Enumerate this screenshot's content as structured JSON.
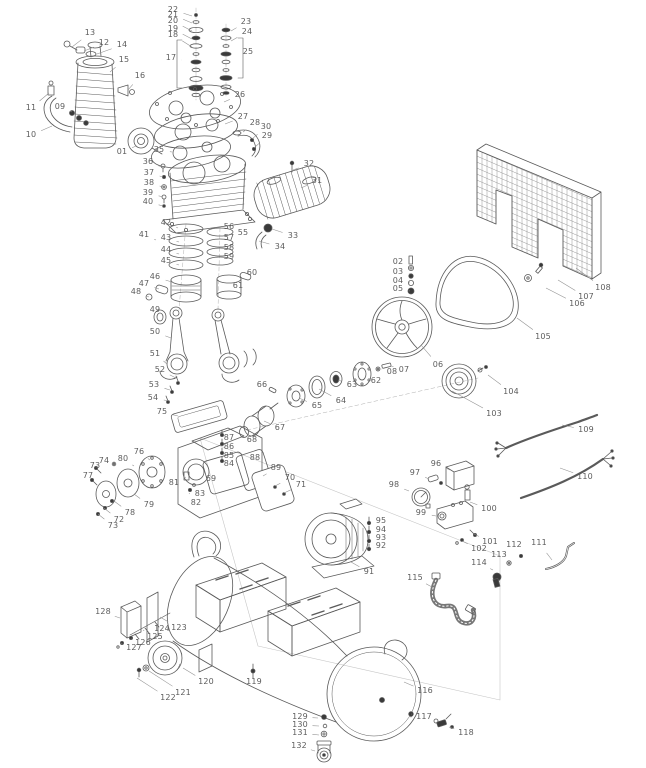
{
  "figure": {
    "width": 646,
    "height": 768,
    "kind": "exploded-parts-diagram",
    "subject": "belt-drive air compressor"
  },
  "colors": {
    "background": "#ffffff",
    "line": "#5a5a5a",
    "label": "#5d5d5d",
    "leader": "#909090",
    "dark_fill": "#3a3a3a",
    "construction": "#c6c6c6"
  },
  "diagram": {
    "labels": [
      {
        "n": "13",
        "x": 90,
        "y": 33,
        "tx": 72,
        "ty": 47
      },
      {
        "n": "12",
        "x": 104,
        "y": 43,
        "tx": 84,
        "ty": 51
      },
      {
        "n": "14",
        "x": 122,
        "y": 45,
        "tx": 97,
        "ty": 54
      },
      {
        "n": "15",
        "x": 124,
        "y": 60,
        "tx": 110,
        "ty": 72
      },
      {
        "n": "16",
        "x": 140,
        "y": 76,
        "tx": 128,
        "ty": 90
      },
      {
        "n": "11",
        "x": 31,
        "y": 108,
        "tx": 49,
        "ty": 93
      },
      {
        "n": "09",
        "x": 60,
        "y": 107,
        "tx": 72,
        "ty": 112
      },
      {
        "n": "10",
        "x": 31,
        "y": 135,
        "tx": 52,
        "ty": 126
      },
      {
        "n": "01",
        "x": 122,
        "y": 152,
        "tx": 136,
        "ty": 146
      },
      {
        "n": "22",
        "x": 173,
        "y": 10,
        "tx": 192,
        "ty": 16
      },
      {
        "n": "21",
        "x": 173,
        "y": 15,
        "tx": 192,
        "ty": 23
      },
      {
        "n": "20",
        "x": 173,
        "y": 21,
        "tx": 192,
        "ty": 31
      },
      {
        "n": "19",
        "x": 173,
        "y": 29,
        "tx": 192,
        "ty": 39
      },
      {
        "n": "18",
        "x": 173,
        "y": 35,
        "tx": 192,
        "ty": 47
      },
      {
        "n": "17",
        "x": 171,
        "y": 58,
        "tx": 182,
        "ty": 60
      },
      {
        "n": "23",
        "x": 246,
        "y": 22,
        "tx": 231,
        "ty": 31
      },
      {
        "n": "24",
        "x": 247,
        "y": 32,
        "tx": 231,
        "ty": 41
      },
      {
        "n": "25",
        "x": 248,
        "y": 52,
        "tx": 240,
        "ty": 55
      },
      {
        "n": "26",
        "x": 240,
        "y": 95,
        "tx": 224,
        "ty": 102
      },
      {
        "n": "27",
        "x": 243,
        "y": 117,
        "tx": 225,
        "ty": 124
      },
      {
        "n": "28",
        "x": 255,
        "y": 123,
        "tx": 243,
        "ty": 132
      },
      {
        "n": "30",
        "x": 266,
        "y": 127,
        "tx": 252,
        "ty": 139
      },
      {
        "n": "29",
        "x": 267,
        "y": 136,
        "tx": 254,
        "ty": 148
      },
      {
        "n": "32",
        "x": 309,
        "y": 164,
        "tx": 293,
        "ty": 170
      },
      {
        "n": "31",
        "x": 317,
        "y": 181,
        "tx": 301,
        "ty": 188
      },
      {
        "n": "33",
        "x": 293,
        "y": 236,
        "tx": 272,
        "ty": 229
      },
      {
        "n": "34",
        "x": 280,
        "y": 247,
        "tx": 259,
        "ty": 241
      },
      {
        "n": "35",
        "x": 159,
        "y": 150,
        "tx": 172,
        "ty": 152
      },
      {
        "n": "36",
        "x": 148,
        "y": 162,
        "tx": 162,
        "ty": 167
      },
      {
        "n": "37",
        "x": 149,
        "y": 173,
        "tx": 163,
        "ty": 177
      },
      {
        "n": "38",
        "x": 149,
        "y": 183,
        "tx": 163,
        "ty": 187
      },
      {
        "n": "39",
        "x": 148,
        "y": 193,
        "tx": 163,
        "ty": 197
      },
      {
        "n": "40",
        "x": 148,
        "y": 202,
        "tx": 163,
        "ty": 206
      },
      {
        "n": "41",
        "x": 144,
        "y": 235,
        "tx": 156,
        "ty": 240
      },
      {
        "n": "42",
        "x": 166,
        "y": 223,
        "tx": 178,
        "ty": 228
      },
      {
        "n": "43",
        "x": 166,
        "y": 238,
        "tx": 179,
        "ty": 242
      },
      {
        "n": "44",
        "x": 166,
        "y": 250,
        "tx": 179,
        "ty": 254
      },
      {
        "n": "45",
        "x": 166,
        "y": 261,
        "tx": 179,
        "ty": 265
      },
      {
        "n": "46",
        "x": 155,
        "y": 277,
        "tx": 172,
        "ty": 282
      },
      {
        "n": "47",
        "x": 144,
        "y": 284,
        "tx": 159,
        "ty": 289
      },
      {
        "n": "48",
        "x": 136,
        "y": 292,
        "tx": 149,
        "ty": 297
      },
      {
        "n": "49",
        "x": 155,
        "y": 310,
        "tx": 159,
        "ty": 316
      },
      {
        "n": "50",
        "x": 155,
        "y": 332,
        "tx": 171,
        "ty": 338
      },
      {
        "n": "55",
        "x": 243,
        "y": 233,
        "tx": 234,
        "ty": 238
      },
      {
        "n": "56",
        "x": 229,
        "y": 227,
        "tx": 221,
        "ty": 232
      },
      {
        "n": "57",
        "x": 229,
        "y": 238,
        "tx": 221,
        "ty": 243
      },
      {
        "n": "58",
        "x": 229,
        "y": 248,
        "tx": 221,
        "ty": 252
      },
      {
        "n": "59",
        "x": 229,
        "y": 257,
        "tx": 221,
        "ty": 261
      },
      {
        "n": "60",
        "x": 252,
        "y": 273,
        "tx": 245,
        "ty": 277
      },
      {
        "n": "61",
        "x": 238,
        "y": 286,
        "tx": 231,
        "ty": 288
      },
      {
        "n": "51",
        "x": 155,
        "y": 354,
        "tx": 167,
        "ty": 364
      },
      {
        "n": "52",
        "x": 160,
        "y": 370,
        "tx": 176,
        "ty": 378
      },
      {
        "n": "53",
        "x": 154,
        "y": 385,
        "tx": 170,
        "ty": 390
      },
      {
        "n": "54",
        "x": 153,
        "y": 398,
        "tx": 169,
        "ty": 401
      },
      {
        "n": "75",
        "x": 162,
        "y": 412,
        "tx": 178,
        "ty": 416
      },
      {
        "n": "76",
        "x": 139,
        "y": 452,
        "tx": 150,
        "ty": 460
      },
      {
        "n": "80",
        "x": 123,
        "y": 459,
        "tx": 134,
        "ty": 466
      },
      {
        "n": "74",
        "x": 104,
        "y": 461,
        "tx": 114,
        "ty": 465
      },
      {
        "n": "73",
        "x": 95,
        "y": 466,
        "tx": 104,
        "ty": 470
      },
      {
        "n": "77",
        "x": 88,
        "y": 476,
        "tx": 96,
        "ty": 482
      },
      {
        "n": "79",
        "x": 149,
        "y": 505,
        "tx": 134,
        "ty": 494
      },
      {
        "n": "78",
        "x": 130,
        "y": 513,
        "tx": 114,
        "ty": 501
      },
      {
        "n": "72",
        "x": 119,
        "y": 520,
        "tx": 104,
        "ty": 508
      },
      {
        "n": "73",
        "x": 113,
        "y": 526,
        "tx": 98,
        "ty": 514
      },
      {
        "n": "81",
        "x": 174,
        "y": 483,
        "tx": 186,
        "ty": 477
      },
      {
        "n": "83",
        "x": 200,
        "y": 494,
        "tx": 193,
        "ty": 486
      },
      {
        "n": "82",
        "x": 196,
        "y": 503,
        "tx": 189,
        "ty": 493
      },
      {
        "n": "87",
        "x": 229,
        "y": 438,
        "tx": 222,
        "ty": 433
      },
      {
        "n": "86",
        "x": 229,
        "y": 447,
        "tx": 222,
        "ty": 443
      },
      {
        "n": "85",
        "x": 229,
        "y": 456,
        "tx": 222,
        "ty": 452
      },
      {
        "n": "84",
        "x": 229,
        "y": 464,
        "tx": 222,
        "ty": 460
      },
      {
        "n": "69",
        "x": 211,
        "y": 479,
        "tx": 203,
        "ty": 472
      },
      {
        "n": "88",
        "x": 255,
        "y": 458,
        "tx": 247,
        "ty": 464
      },
      {
        "n": "89",
        "x": 276,
        "y": 468,
        "tx": 263,
        "ty": 476
      },
      {
        "n": "70",
        "x": 290,
        "y": 478,
        "tx": 275,
        "ty": 486
      },
      {
        "n": "71",
        "x": 301,
        "y": 485,
        "tx": 284,
        "ty": 493
      },
      {
        "n": "68",
        "x": 252,
        "y": 440,
        "tx": 244,
        "ty": 434
      },
      {
        "n": "67",
        "x": 280,
        "y": 428,
        "tx": 264,
        "ty": 421
      },
      {
        "n": "66",
        "x": 262,
        "y": 385,
        "tx": 271,
        "ty": 390
      },
      {
        "n": "65",
        "x": 317,
        "y": 406,
        "tx": 299,
        "ty": 398
      },
      {
        "n": "64",
        "x": 341,
        "y": 401,
        "tx": 319,
        "ty": 389
      },
      {
        "n": "63",
        "x": 352,
        "y": 385,
        "tx": 338,
        "ty": 380
      },
      {
        "n": "62",
        "x": 376,
        "y": 381,
        "tx": 365,
        "ty": 376
      },
      {
        "n": "08",
        "x": 392,
        "y": 372,
        "tx": 381,
        "ty": 369
      },
      {
        "n": "07",
        "x": 404,
        "y": 370,
        "tx": 391,
        "ty": 366
      },
      {
        "n": "06",
        "x": 438,
        "y": 365,
        "tx": 421,
        "ty": 345
      },
      {
        "n": "02",
        "x": 398,
        "y": 262,
        "tx": 410,
        "ty": 264
      },
      {
        "n": "03",
        "x": 398,
        "y": 272,
        "tx": 410,
        "ty": 274
      },
      {
        "n": "04",
        "x": 398,
        "y": 281,
        "tx": 410,
        "ty": 283
      },
      {
        "n": "05",
        "x": 398,
        "y": 289,
        "tx": 410,
        "ty": 291
      },
      {
        "n": "105",
        "x": 543,
        "y": 337,
        "tx": 517,
        "ty": 318
      },
      {
        "n": "108",
        "x": 603,
        "y": 288,
        "tx": 576,
        "ty": 268
      },
      {
        "n": "107",
        "x": 586,
        "y": 297,
        "tx": 558,
        "ty": 280
      },
      {
        "n": "106",
        "x": 577,
        "y": 304,
        "tx": 546,
        "ty": 288
      },
      {
        "n": "104",
        "x": 511,
        "y": 392,
        "tx": 488,
        "ty": 375
      },
      {
        "n": "103",
        "x": 494,
        "y": 414,
        "tx": 452,
        "ty": 391
      },
      {
        "n": "109",
        "x": 586,
        "y": 430,
        "tx": 562,
        "ty": 425
      },
      {
        "n": "110",
        "x": 585,
        "y": 477,
        "tx": 560,
        "ty": 468
      },
      {
        "n": "96",
        "x": 436,
        "y": 464,
        "tx": 450,
        "ty": 470
      },
      {
        "n": "97",
        "x": 415,
        "y": 473,
        "tx": 429,
        "ty": 479
      },
      {
        "n": "98",
        "x": 394,
        "y": 485,
        "tx": 409,
        "ty": 491
      },
      {
        "n": "99",
        "x": 421,
        "y": 513,
        "tx": 436,
        "ty": 516
      },
      {
        "n": "100",
        "x": 489,
        "y": 509,
        "tx": 470,
        "ty": 502
      },
      {
        "n": "95",
        "x": 381,
        "y": 521,
        "tx": 371,
        "ty": 523
      },
      {
        "n": "94",
        "x": 381,
        "y": 530,
        "tx": 371,
        "ty": 531
      },
      {
        "n": "93",
        "x": 381,
        "y": 538,
        "tx": 371,
        "ty": 540
      },
      {
        "n": "92",
        "x": 381,
        "y": 546,
        "tx": 371,
        "ty": 548
      },
      {
        "n": "91",
        "x": 369,
        "y": 572,
        "tx": 351,
        "ty": 562
      },
      {
        "n": "101",
        "x": 490,
        "y": 542,
        "tx": 474,
        "ty": 534
      },
      {
        "n": "102",
        "x": 479,
        "y": 549,
        "tx": 462,
        "ty": 541
      },
      {
        "n": "112",
        "x": 514,
        "y": 545,
        "tx": 521,
        "ty": 554
      },
      {
        "n": "111",
        "x": 539,
        "y": 543,
        "tx": 552,
        "ty": 560
      },
      {
        "n": "113",
        "x": 499,
        "y": 555,
        "tx": 508,
        "ty": 562
      },
      {
        "n": "114",
        "x": 479,
        "y": 563,
        "tx": 493,
        "ty": 570
      },
      {
        "n": "115",
        "x": 415,
        "y": 578,
        "tx": 432,
        "ty": 587
      },
      {
        "n": "128",
        "x": 103,
        "y": 612,
        "tx": 120,
        "ty": 618
      },
      {
        "n": "124",
        "x": 162,
        "y": 629,
        "tx": 152,
        "ty": 622
      },
      {
        "n": "123",
        "x": 179,
        "y": 628,
        "tx": 160,
        "ty": 617
      },
      {
        "n": "125",
        "x": 155,
        "y": 637,
        "tx": 143,
        "ty": 630
      },
      {
        "n": "126",
        "x": 143,
        "y": 643,
        "tx": 131,
        "ty": 638
      },
      {
        "n": "127",
        "x": 134,
        "y": 648,
        "tx": 121,
        "ty": 643
      },
      {
        "n": "120",
        "x": 206,
        "y": 682,
        "tx": 183,
        "ty": 668
      },
      {
        "n": "121",
        "x": 183,
        "y": 693,
        "tx": 149,
        "ty": 671
      },
      {
        "n": "122",
        "x": 168,
        "y": 698,
        "tx": 137,
        "ty": 678
      },
      {
        "n": "119",
        "x": 254,
        "y": 682,
        "tx": 253,
        "ty": 673
      },
      {
        "n": "116",
        "x": 425,
        "y": 691,
        "tx": 404,
        "ty": 682
      },
      {
        "n": "117",
        "x": 424,
        "y": 717,
        "tx": 411,
        "ty": 714
      },
      {
        "n": "118",
        "x": 466,
        "y": 733,
        "tx": 449,
        "ty": 727
      },
      {
        "n": "129",
        "x": 300,
        "y": 717,
        "tx": 318,
        "ty": 718
      },
      {
        "n": "130",
        "x": 300,
        "y": 725,
        "tx": 319,
        "ty": 726
      },
      {
        "n": "131",
        "x": 300,
        "y": 733,
        "tx": 319,
        "ty": 735
      },
      {
        "n": "132",
        "x": 299,
        "y": 746,
        "tx": 315,
        "ty": 751
      }
    ]
  }
}
